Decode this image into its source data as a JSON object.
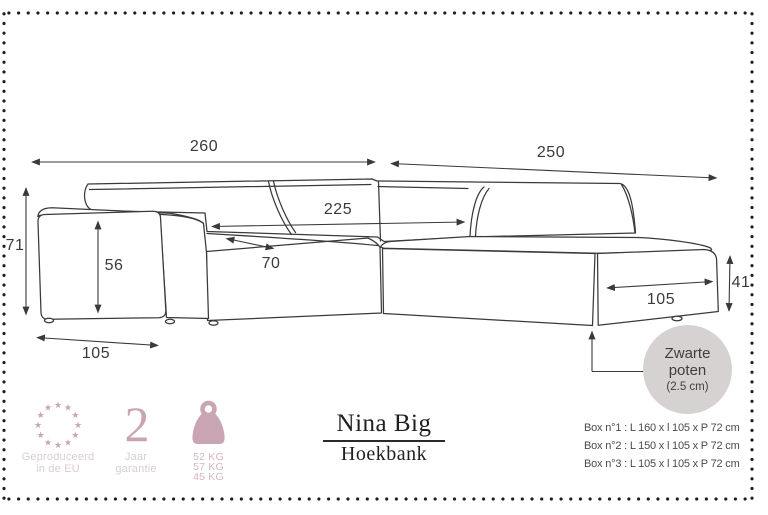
{
  "colors": {
    "line": "#3a3a3a",
    "accent_pink": "#c9a4b2",
    "caption_pink": "#d9cdd2",
    "kg_pink": "#d5b7c1",
    "callout_gray": "#d6d2d1",
    "title_black": "#1f1f1f",
    "box_text_gray": "#4a4a4a"
  },
  "icons": {
    "eu": "eu-stars-icon",
    "weight": "weight-icon"
  },
  "diagram": {
    "dimensions": {
      "total_width": "260",
      "chaise_total_depth": "250",
      "inner_back_width": "225",
      "total_height": "71",
      "armrest_height": "56",
      "seat_depth": "70",
      "armrest_depth": "105",
      "chaise_front_width": "105",
      "chaise_height": "41"
    },
    "leg_callout": {
      "line1": "Zwarte",
      "line2": "poten",
      "line3": "(2.5 cm)"
    }
  },
  "footer": {
    "eu_badge": {
      "caption": [
        "Geproduceerd",
        "in de EU"
      ]
    },
    "warranty_badge": {
      "number": "2",
      "caption": [
        "Jaar",
        "garantie"
      ]
    },
    "weight_badge": {
      "values": [
        "52 KG",
        "57 KG",
        "45 KG"
      ]
    },
    "product": {
      "name": "Nina Big",
      "type": "Hoekbank"
    },
    "boxes": [
      "Box n°1 : L 160 x l 105 x P 72 cm",
      "Box n°2 : L 150 x l 105 x P 72 cm",
      "Box n°3 : L 105 x l 105 x P 72 cm"
    ]
  }
}
